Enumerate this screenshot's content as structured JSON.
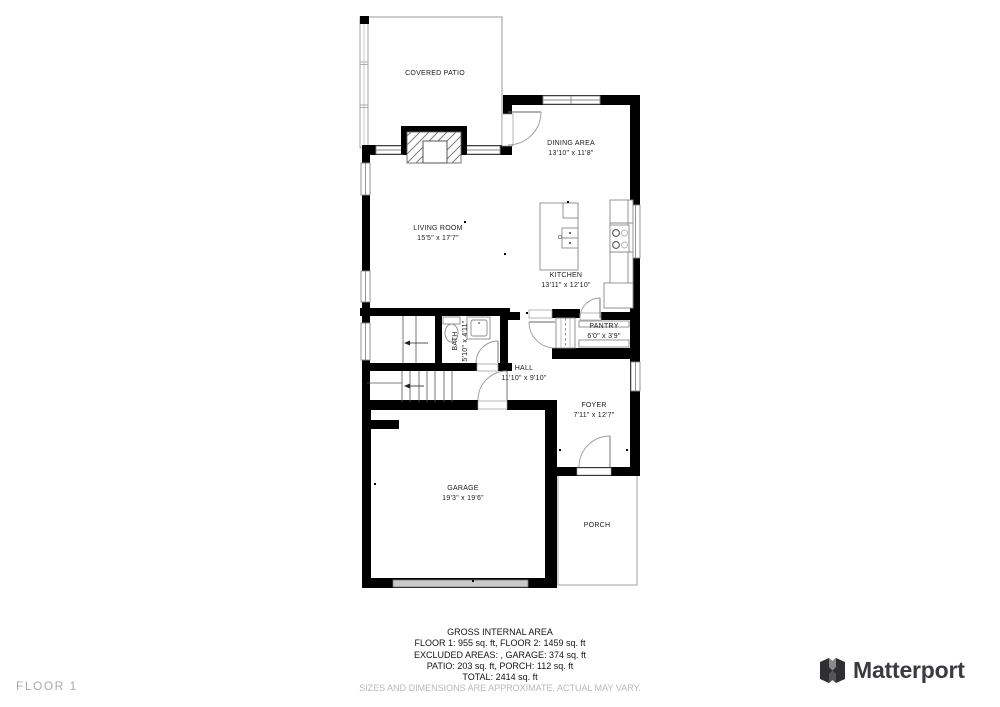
{
  "floor_label": "FLOOR 1",
  "logo": {
    "brand": "Matterport"
  },
  "rooms": {
    "covered_patio": {
      "name": "COVERED PATIO",
      "dims": ""
    },
    "dining_area": {
      "name": "DINING AREA",
      "dims": "13'10\" x 11'8\""
    },
    "living_room": {
      "name": "LIVING ROOM",
      "dims": "15'5\" x 17'7\""
    },
    "kitchen": {
      "name": "KITCHEN",
      "dims": "13'11\" x 12'10\""
    },
    "pantry": {
      "name": "PANTRY",
      "dims": "6'0\" x 3'9\""
    },
    "bath": {
      "name": "BATH",
      "dims": "5'10\" x 4'11\""
    },
    "hall": {
      "name": "HALL",
      "dims": "11'10\" x 9'10\""
    },
    "foyer": {
      "name": "FOYER",
      "dims": "7'11\" x 12'7\""
    },
    "garage": {
      "name": "GARAGE",
      "dims": "19'3\" x 19'6\""
    },
    "porch": {
      "name": "PORCH",
      "dims": ""
    }
  },
  "footer": {
    "title": "GROSS INTERNAL AREA",
    "line1": "FLOOR 1: 955 sq. ft, FLOOR 2: 1459 sq. ft",
    "line2": "EXCLUDED AREAS: , GARAGE: 374 sq. ft",
    "line3": "PATIO: 203 sq. ft, PORCH: 112 sq. ft",
    "line4": "TOTAL: 2414 sq. ft",
    "disclaimer": "SIZES AND DIMENSIONS ARE APPROXIMATE, ACTUAL MAY VARY."
  },
  "colors": {
    "wall": "#000000",
    "background": "#ffffff",
    "window_stroke": "#8a8a8a",
    "muted_text": "#b8b8b8",
    "floor_label_text": "#a9a9a9",
    "logo_text": "#3b3b3f",
    "garage_door_fill": "#c9c9c9"
  }
}
